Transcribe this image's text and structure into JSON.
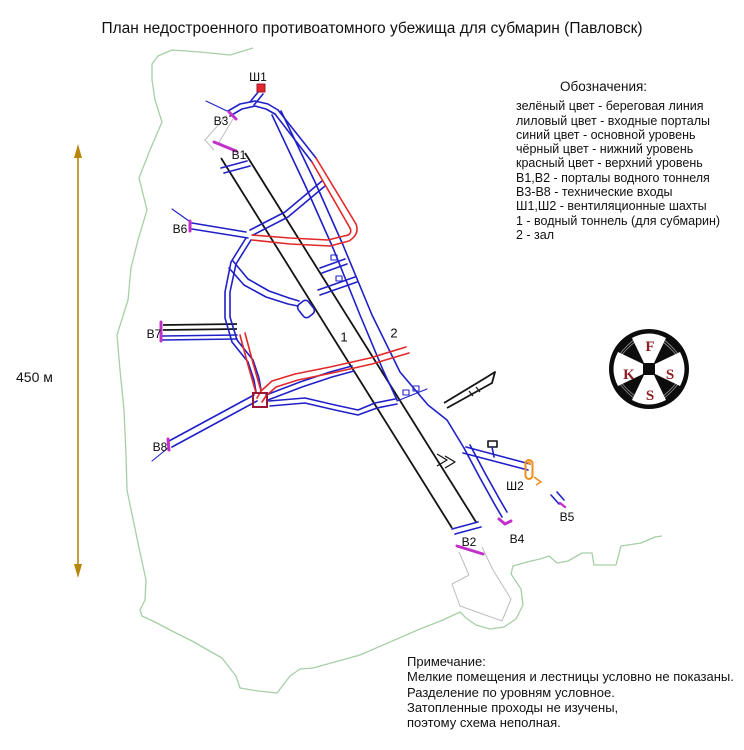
{
  "title": "План недостроенного противоатомного убежища для субмарин (Павловск)",
  "legend": {
    "heading": "Обозначения:",
    "items": [
      "зелёный цвет - береговая линия",
      "лиловый цвет - входные порталы",
      "синий цвет - основной уровень",
      "чёрный цвет - нижний уровень",
      "красный цвет - верхний уровень",
      "В1,В2 - порталы водного тоннеля",
      "В3-В8 - технические входы",
      "Ш1,Ш2 - вентиляционные шахты",
      "1 - водный тоннель (для субмарин)",
      "2 - зал"
    ]
  },
  "notes": {
    "heading": "Примечание:",
    "lines": [
      "Мелкие помещения  и лестницы условно не показаны.",
      "Разделение по уровням условное.",
      "Затопленные проходы не изучены,",
      "поэтому схема неполная."
    ]
  },
  "scale": {
    "label": "450 м"
  },
  "map_labels": [
    {
      "id": "sh1",
      "text": "Ш1"
    },
    {
      "id": "v3",
      "text": "В3"
    },
    {
      "id": "v1",
      "text": "В1"
    },
    {
      "id": "v6",
      "text": "В6"
    },
    {
      "id": "v7",
      "text": "В7"
    },
    {
      "id": "v8",
      "text": "В8"
    },
    {
      "id": "t1",
      "text": "1"
    },
    {
      "id": "t2",
      "text": "2"
    },
    {
      "id": "sh2",
      "text": "Ш2"
    },
    {
      "id": "v4",
      "text": "В4"
    },
    {
      "id": "v5",
      "text": "В5"
    },
    {
      "id": "v2",
      "text": "В2"
    }
  ],
  "logo": {
    "letter_top": "F",
    "letter_left": "K",
    "letter_right": "S",
    "letter_bottom": "S"
  },
  "colors": {
    "coastline_green": "#a6cfa6",
    "portal_lilac": "#c330c9",
    "main_level_blue": "#2020c8",
    "lower_level_black": "#141414",
    "upper_level_red": "#e22828",
    "junction_darkred": "#9e1535",
    "vent_orange": "#ef8e1b",
    "scale_arrow": "#b8860b",
    "faint_gray": "#bdbdbd",
    "logo_letter_red": "#8b1f24"
  }
}
